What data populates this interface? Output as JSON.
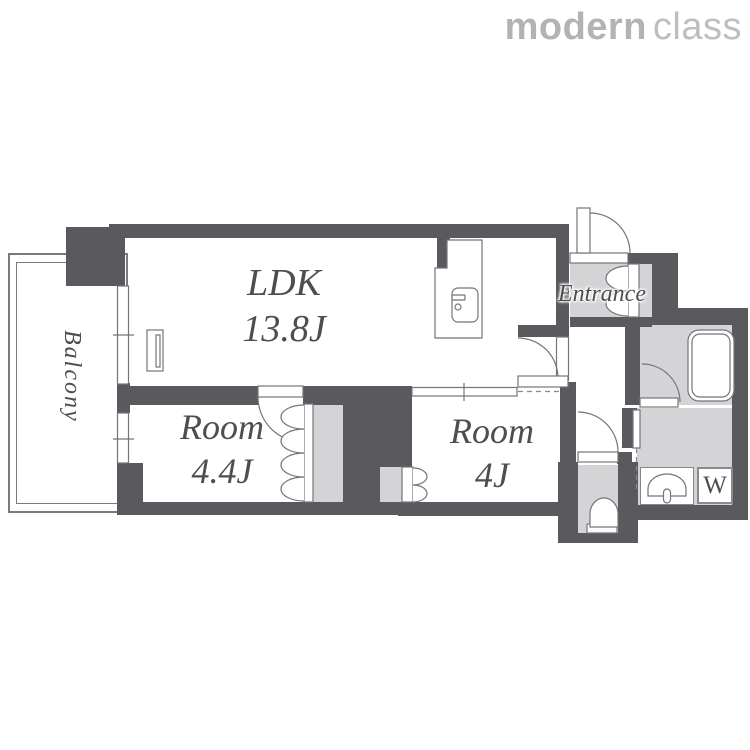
{
  "logo": {
    "part_bold": "modern",
    "part_light": "class"
  },
  "floorplan": {
    "balcony_label": "Balcony",
    "entrance_label": "Entrance",
    "washer_label": "W",
    "rooms": {
      "ldk": {
        "name": "LDK",
        "area": "13.8J"
      },
      "bedroom_a": {
        "name": "Room",
        "area": "4.4J"
      },
      "bedroom_b": {
        "name": "Room",
        "area": "4J"
      }
    },
    "colors": {
      "wall": "#5A5A5E",
      "floor_light": "#D4D4D6",
      "outline": "#75757A",
      "text": "#4D4D52",
      "logo": "#B3B3B5"
    }
  }
}
